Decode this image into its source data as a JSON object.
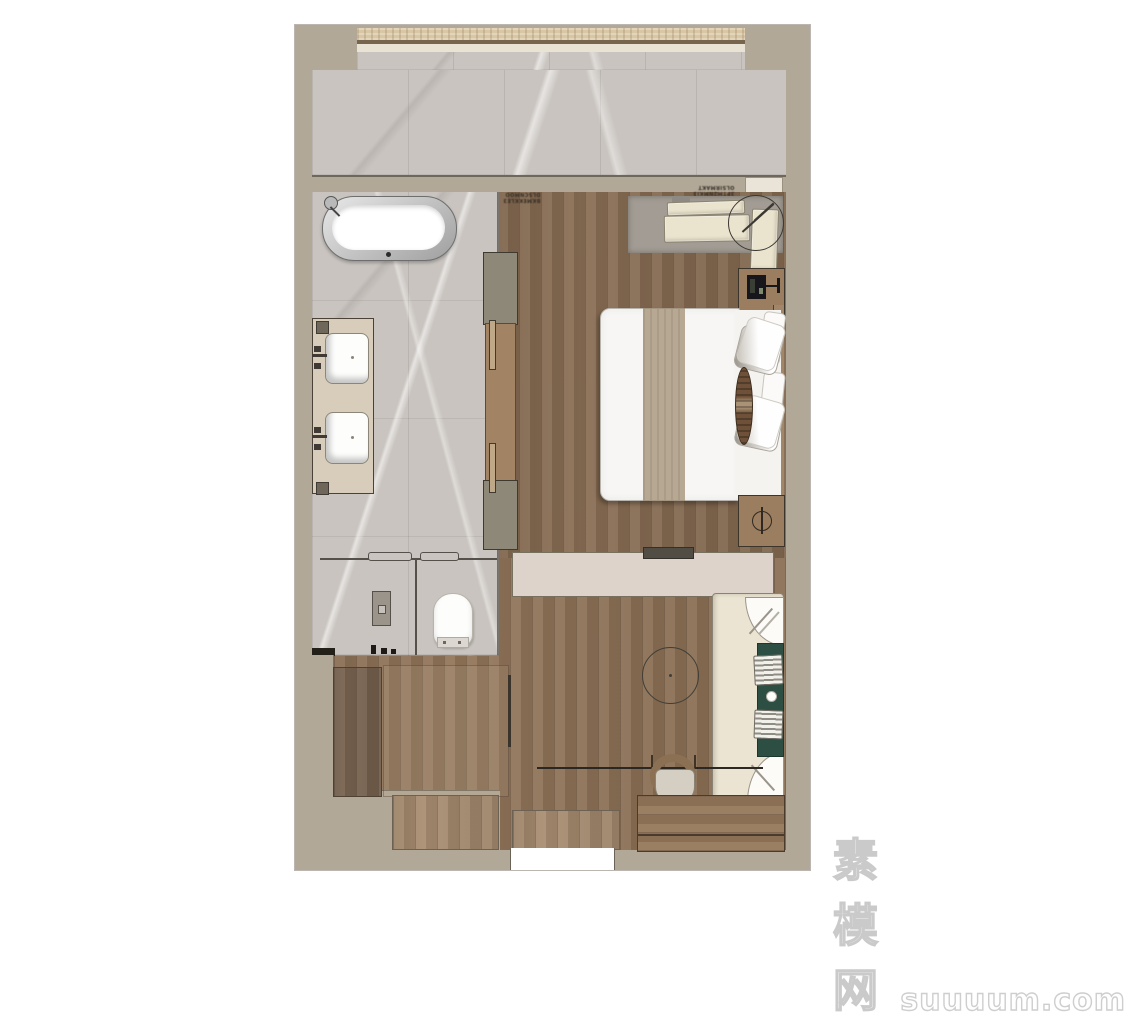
{
  "watermark": {
    "cjk": "素模网",
    "latin": "suuuum.com"
  },
  "annotations": {
    "bedroom_entry_line1": "DLSCNMOO",
    "bedroom_entry_line2": "BKMEKKLE3",
    "lounge_line1": "OLSIRMAKT",
    "lounge_line2": "3PTM2NMKI3"
  },
  "palette": {
    "wall": "#b2a897",
    "marble_floor": "#c9c4bf",
    "wood_bedroom": "#8a6e54",
    "wood_living": "#93765a",
    "wood_entry_mat": "#a98e72",
    "wood_dresser": "#7a6450",
    "wood_console": "#96785b",
    "wardrobe_cabinet": "#8d8877",
    "wardrobe_door": "#a28465",
    "tv_console": "#ddd3ca",
    "rug": "#a29c94",
    "cushion_cream": "#eae4cf",
    "cushion_teal": "#2c4e43",
    "sofa_body": "#ebe4d2",
    "bed_runner": "#b6a893",
    "bolster": "#6e5138",
    "curtain_band": "#d8c7a5",
    "fixture_white": "#fdfdfc"
  },
  "icons": {
    "bathtub_faucet": "circle-with-spout",
    "bedside_lamp_symbol": "phi-circle",
    "floor_lamp": "diagonal-arm"
  }
}
